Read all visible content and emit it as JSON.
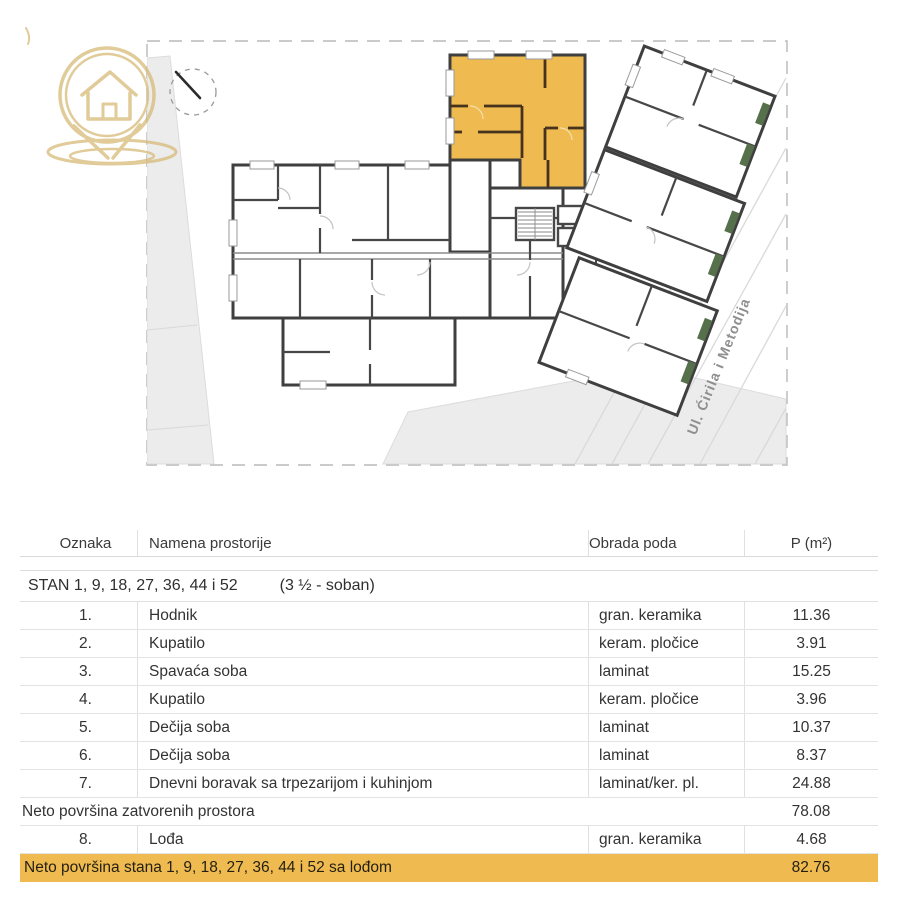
{
  "plan": {
    "street_label": "Ul. Ćirila i Metodija",
    "highlighted_unit": "STAN 1, 9, 18, 27, 36, 44 i 52"
  },
  "icons": {
    "logo": "house-location-pin-logo",
    "compass": "north-arrow-compass"
  },
  "colors": {
    "highlight": "#EFBB50",
    "unit_wall": "#46321D",
    "wall": "#3F3F3F",
    "site_gray": "#ECECEC",
    "logo_gold": "#D5B873",
    "green_accent": "#55704A"
  },
  "table": {
    "headers": {
      "oznaka": "Oznaka",
      "namena": "Namena prostorije",
      "obrada": "Obrada poda",
      "p": "P (m²)"
    },
    "section": {
      "title": "STAN 1, 9, 18, 27, 36, 44 i 52",
      "subtitle": "(3 ½ - soban)"
    },
    "rows": [
      {
        "oznaka": "1.",
        "namena": "Hodnik",
        "obrada": "gran. keramika",
        "p": "11.36"
      },
      {
        "oznaka": "2.",
        "namena": "Kupatilo",
        "obrada": "keram. pločice",
        "p": "3.91"
      },
      {
        "oznaka": "3.",
        "namena": "Spavaća soba",
        "obrada": "laminat",
        "p": "15.25"
      },
      {
        "oznaka": "4.",
        "namena": "Kupatilo",
        "obrada": "keram. pločice",
        "p": "3.96"
      },
      {
        "oznaka": "5.",
        "namena": "Dečija soba",
        "obrada": "laminat",
        "p": "10.37"
      },
      {
        "oznaka": "6.",
        "namena": "Dečija soba",
        "obrada": "laminat",
        "p": "8.37"
      },
      {
        "oznaka": "7.",
        "namena": "Dnevni boravak sa trpezarijom i kuhinjom",
        "obrada": "laminat/ker. pl.",
        "p": "24.88"
      },
      {
        "oznaka": "8.",
        "namena": "Lođa",
        "obrada": "gran. keramika",
        "p": "4.68"
      }
    ],
    "subtotal": {
      "label": "Neto površina zatvorenih prostora",
      "p": "78.08"
    },
    "total": {
      "label": "Neto površina stana 1, 9, 18, 27, 36, 44 i 52 sa lođom",
      "p": "82.76"
    }
  }
}
